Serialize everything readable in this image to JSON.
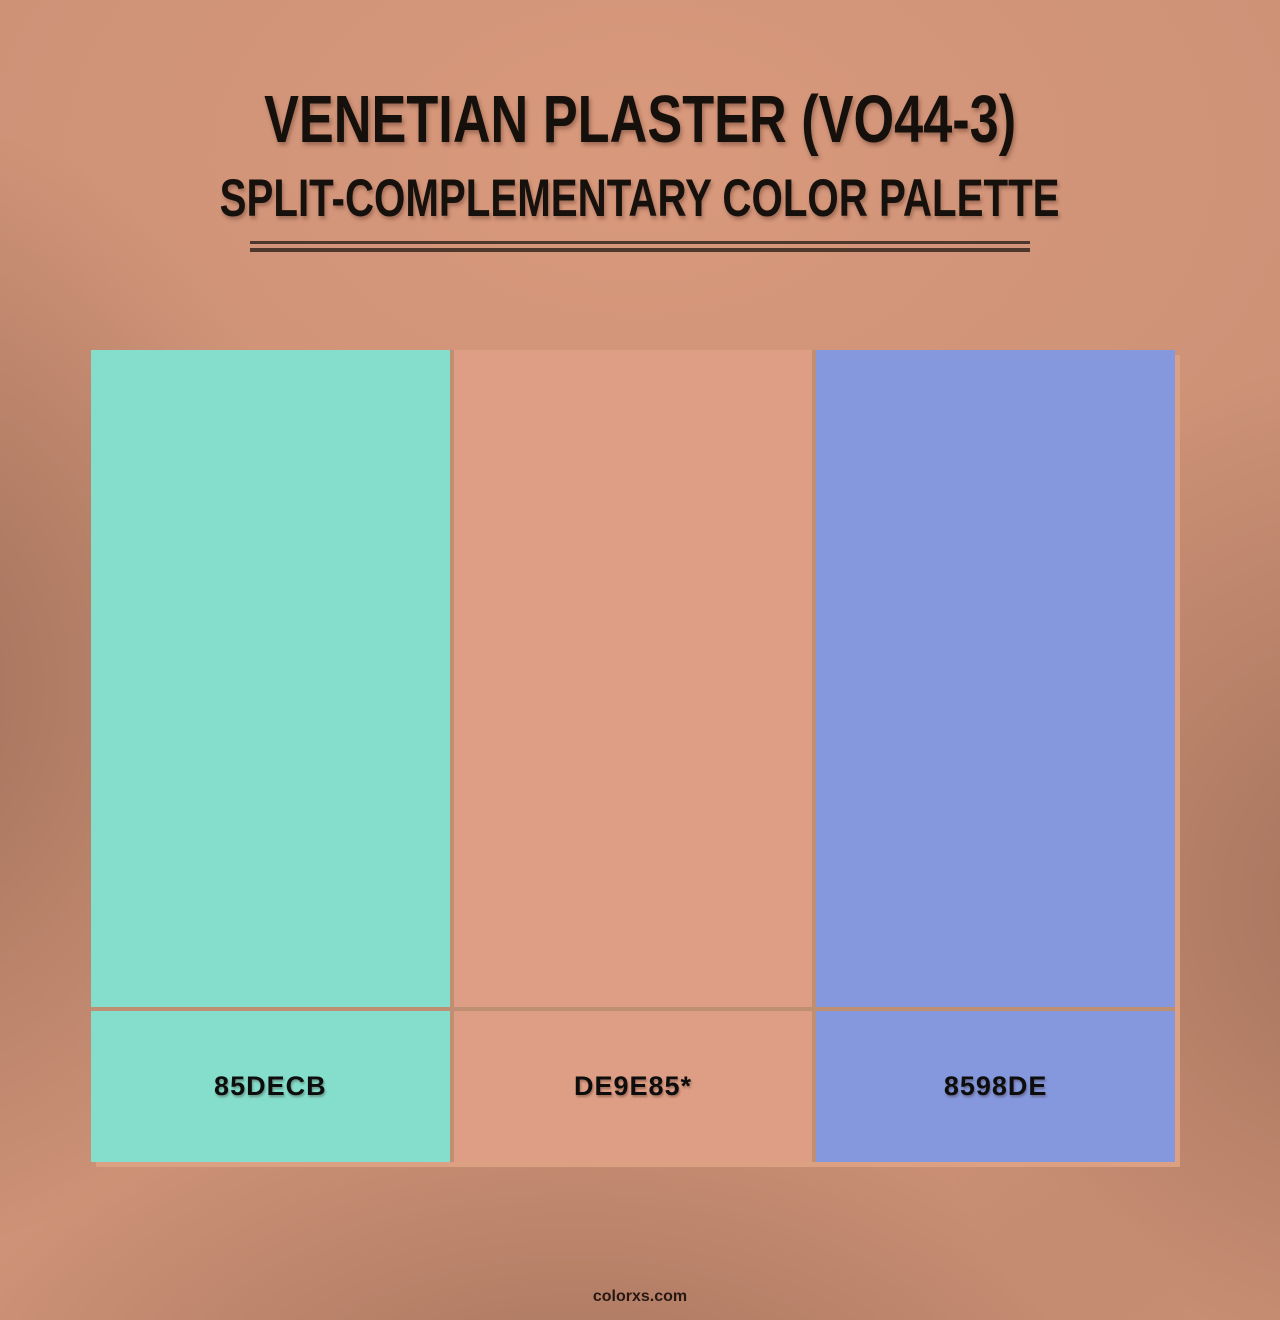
{
  "header": {
    "title": "VENETIAN PLASTER (VO44-3)",
    "subtitle": "SPLIT-COMPLEMENTARY COLOR PALETTE"
  },
  "palette": {
    "swatches": [
      {
        "label": "85DECB",
        "color": "#85DECB"
      },
      {
        "label": "DE9E85*",
        "color": "#DE9E85"
      },
      {
        "label": "8598DE",
        "color": "#8598DE"
      }
    ]
  },
  "footer": {
    "site": "colorxs.com"
  },
  "theme": {
    "background_base": "#CD9277",
    "frame": "#DCA083",
    "gap": "#BF8F73",
    "rule": "#4E382C",
    "title_text": "#15100C"
  }
}
